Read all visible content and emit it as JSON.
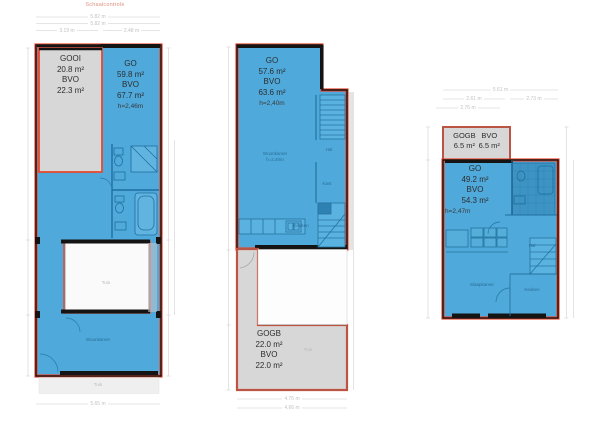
{
  "header": {
    "scale_check": "Schaalcontrole"
  },
  "colors": {
    "plan_fill_blue": "#4fa9db",
    "outline_red": "#e8492f",
    "gray_fill": "#d7d7d7",
    "wall_black": "#141414",
    "fixture_blue": "#1f6f9f",
    "dim_gray": "#d9d9d9"
  },
  "plan1": {
    "gooi": {
      "name": "GOOI",
      "area": "20.8 m²",
      "bvo_label": "BVO",
      "bvo": "22.3 m²"
    },
    "go": {
      "name": "GO",
      "area": "59.8 m²",
      "bvo_label": "BVO",
      "bvo": "67.7 m²",
      "height": "h=2,46m"
    },
    "rooms": {
      "woonkamer": "Woonkamer",
      "tuin_court": "Tuin",
      "tuin_bottom": "Tuin"
    },
    "dims": {
      "top1": "5.82 m",
      "top2": "5.82 m",
      "top_left": "3.19 m",
      "top_right": "2.48 m",
      "bottom": "5.65 m"
    }
  },
  "plan2": {
    "go": {
      "name": "GO",
      "area": "57.6 m²",
      "bvo_label": "BVO",
      "bvo": "63.6 m²",
      "height": "h=2,40m"
    },
    "gogb": {
      "name": "GOGB",
      "area": "22.0 m²",
      "bvo_label": "BVO",
      "bvo": "22.0 m²"
    },
    "rooms": {
      "woonkamer": "Woonkamer",
      "woonkamer_h": "h=2,40m",
      "hal": "Hal",
      "kast": "Kast",
      "keuken": "Keuken",
      "tuin": "Tuin"
    },
    "dims": {
      "bottom1": "4.76 m",
      "bottom2": "4.66 m"
    }
  },
  "plan3": {
    "gogb": {
      "name": "GOGB",
      "area": "6.5 m²",
      "bvo_label": "BVO",
      "bvo": "6.5 m²"
    },
    "go": {
      "name": "GO",
      "area": "49.2 m²",
      "bvo_label": "BVO",
      "bvo": "54.3 m²",
      "height": "h=2,47m"
    },
    "rooms": {
      "slaapkamer": "Slaapkamer",
      "keuken": "Keuken",
      "hal": "Hal"
    },
    "dims": {
      "top1": "5.61 m",
      "top2a": "2.61 m",
      "top2b": "2.73 m",
      "top3": "2.76 m"
    }
  }
}
